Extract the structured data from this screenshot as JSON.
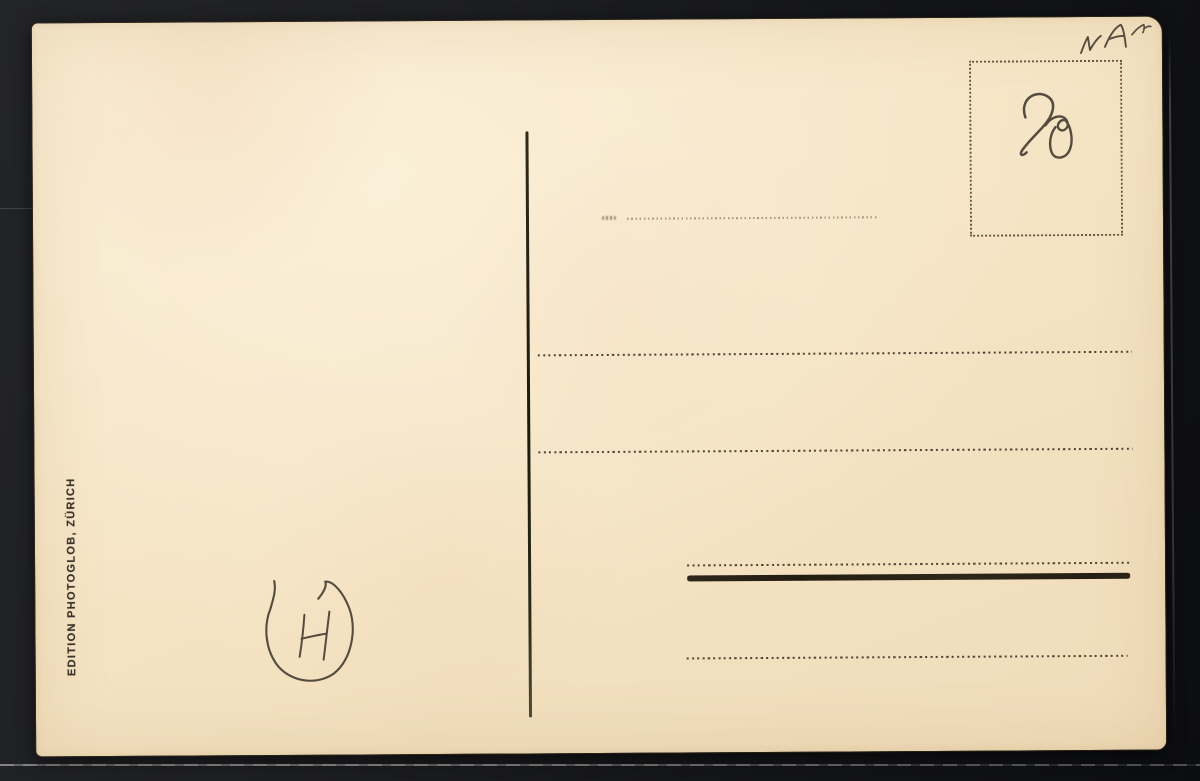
{
  "scan": {
    "background_color": "#1a1b1e",
    "bottom_edge_line": true,
    "table_edge_line": true
  },
  "postcard": {
    "paper_color": "#f5e6c6",
    "ink_color": "#483c2c",
    "pencil_color": "#554b3e",
    "publisher_imprint": "EDITION PHOTOGLOB, ZÜRICH",
    "stamp_box": {
      "handwritten_value": "20"
    },
    "handwriting": {
      "top_right_mark": "NA",
      "circled_letter": "H"
    },
    "address_section": {
      "dotted_line_count": 4,
      "has_thick_rule": true
    },
    "reference_line": {
      "present": true
    }
  }
}
